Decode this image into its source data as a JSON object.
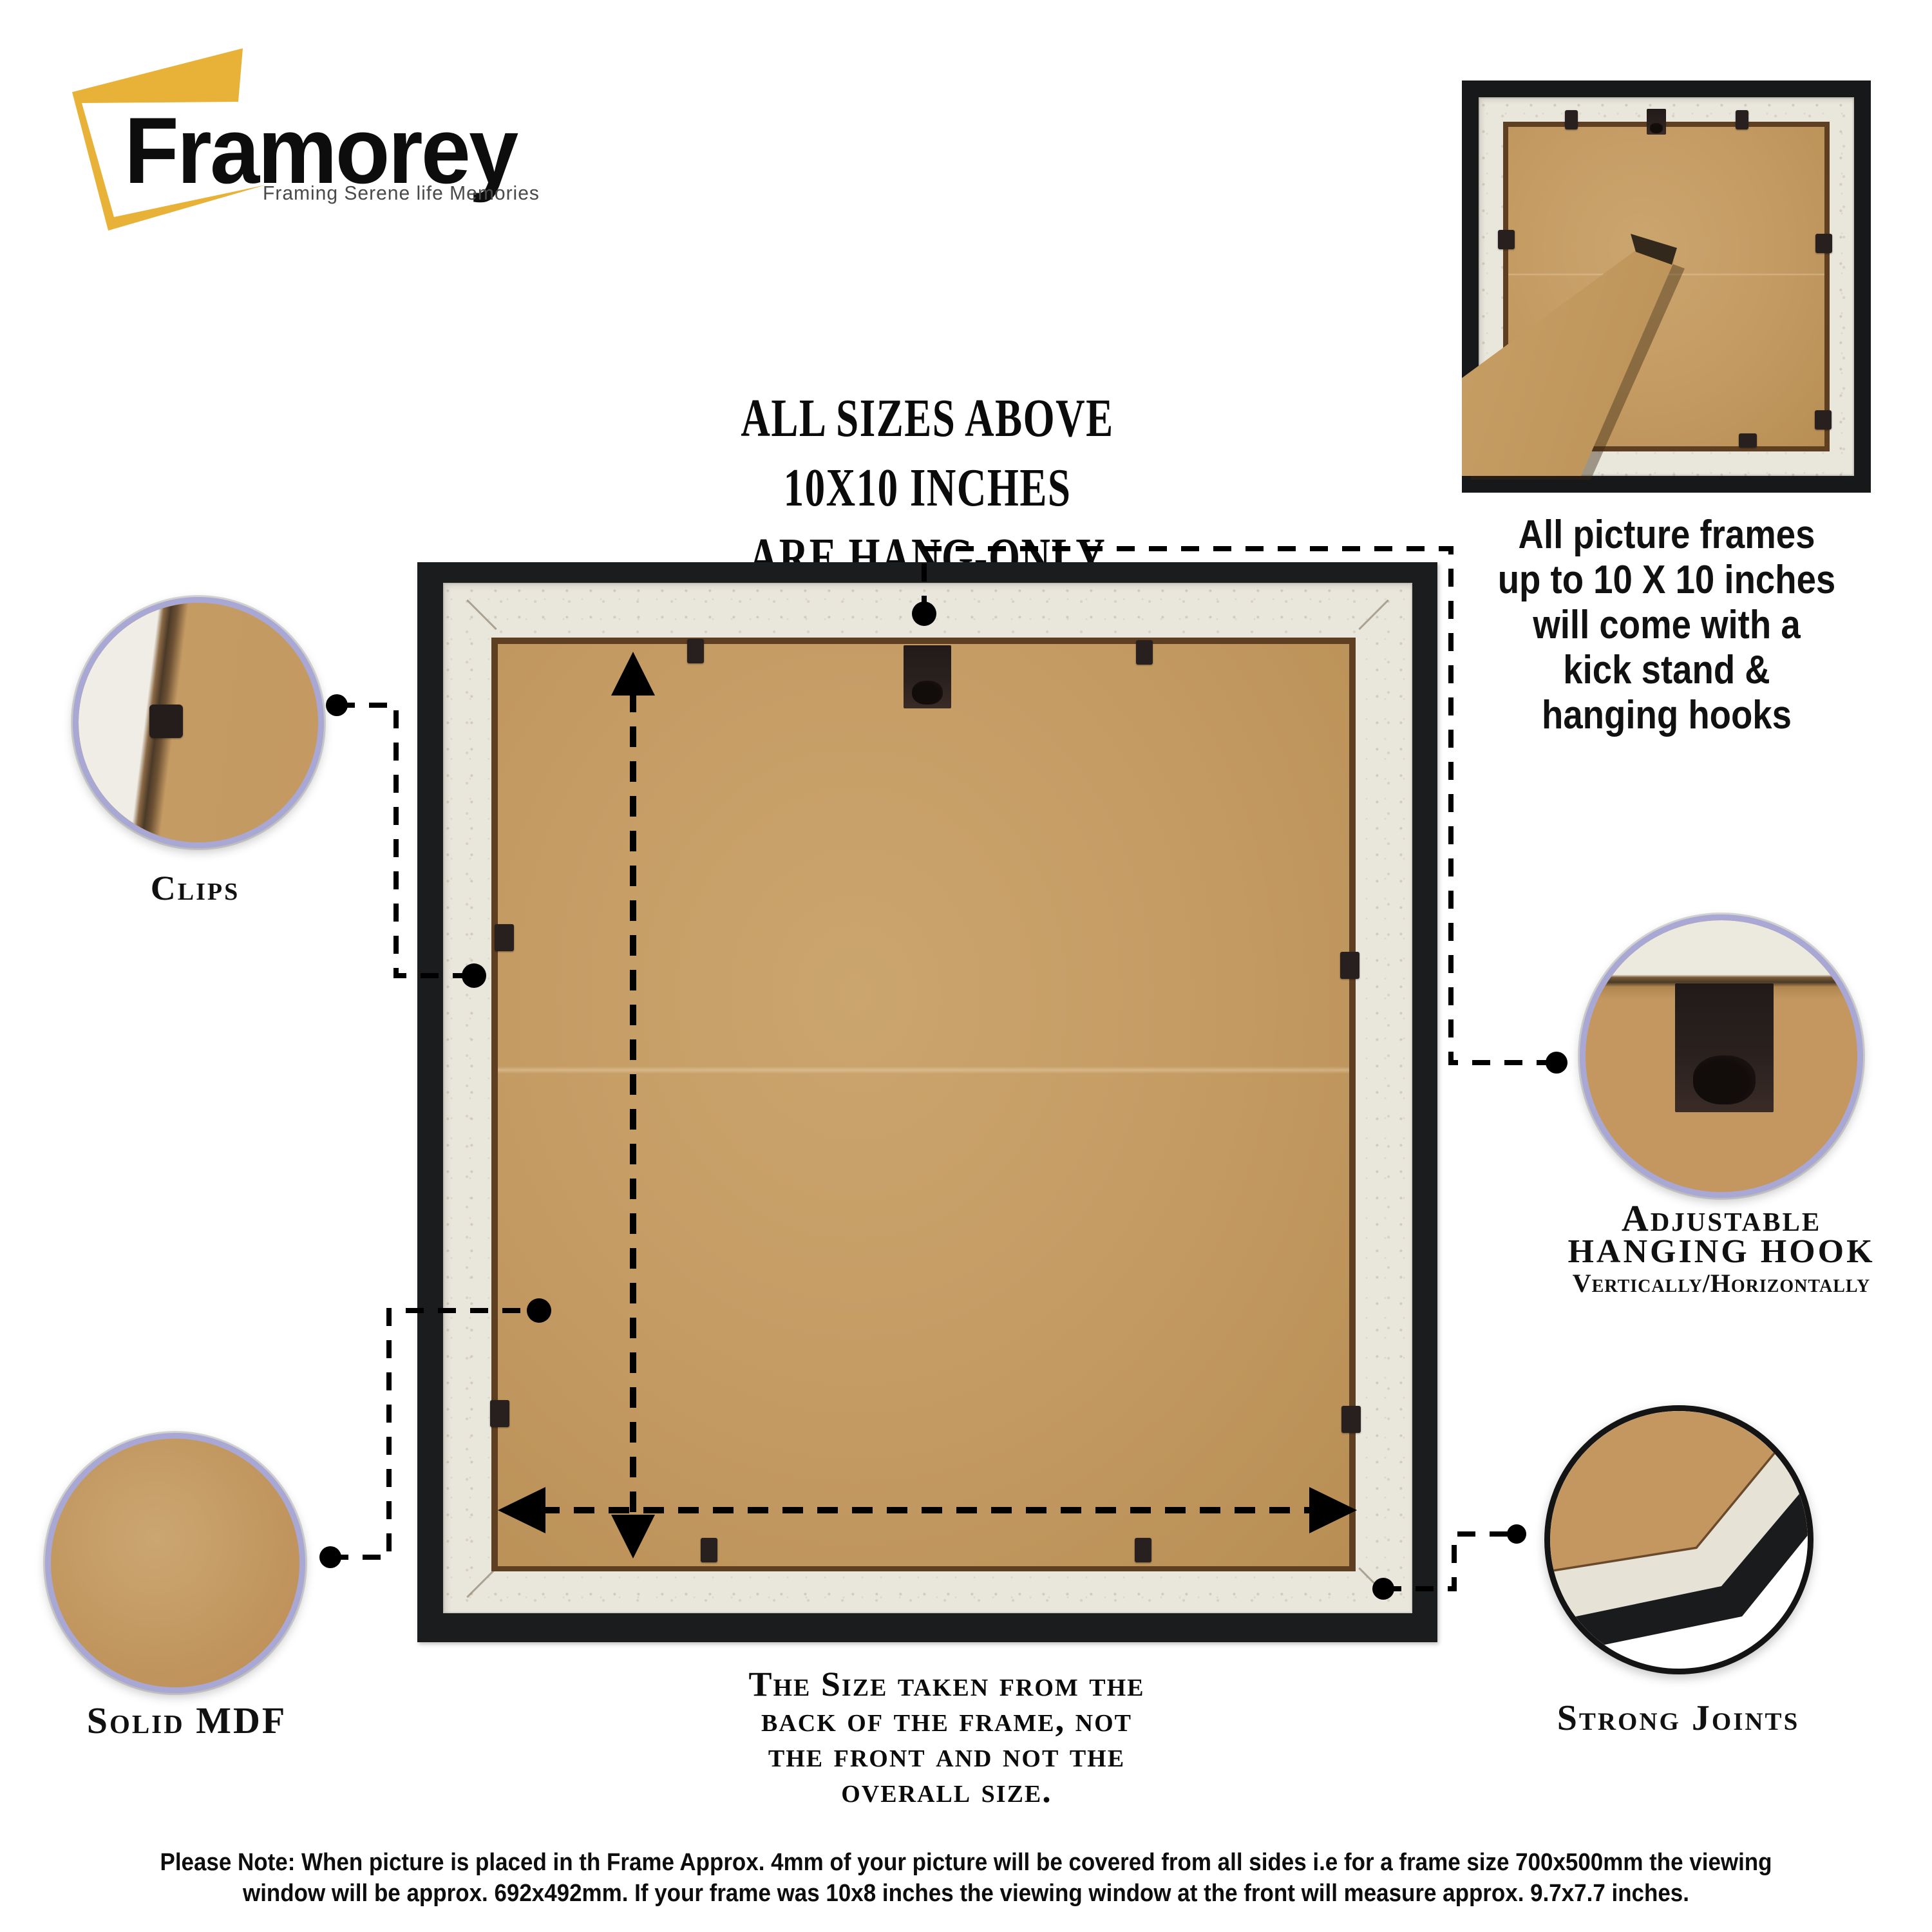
{
  "brand": {
    "name": "Framorey",
    "tagline": "Framing Serene life Memories"
  },
  "heading": {
    "line1": "ALL SIZES ABOVE",
    "line2": "10X10 INCHES",
    "line3": "ARE HANG-ONLY"
  },
  "kickstand_caption": {
    "line1": "All picture frames",
    "line2": "up to 10 X 10 inches",
    "line3": "will come with a",
    "line4": "kick stand &",
    "line5": "hanging hooks"
  },
  "callouts": {
    "clips": {
      "label": "Clips"
    },
    "solid_mdf": {
      "label": "Solid MDF"
    },
    "adjustable_hook": {
      "line1": "Adjustable",
      "line2": "hanging hook",
      "line3": "Vertically/Horizontally"
    },
    "strong_joints": {
      "label": "Strong Joints"
    }
  },
  "size_note": {
    "line1": "The Size taken from the",
    "line2": "back of the frame, not",
    "line3": "the front and not the",
    "line4": "overall size."
  },
  "footer_note": {
    "line1": "Please Note: When picture is placed in th Frame Approx. 4mm of your picture will be covered from all sides i.e for a frame size 700x500mm the viewing",
    "line2": "window will be approx. 692x492mm. If your frame was 10x8 inches the viewing window at the front will measure approx. 9.7x7.7 inches."
  },
  "colors": {
    "accent_yellow": "#E8B238",
    "circle_ring_lavender": "#A9A7D4",
    "circle_ring_black": "#141414",
    "mdf_tan": "#C39A62",
    "board_white": "#E9E6DC",
    "frame_black": "#1B1C1E",
    "connector_black": "#000000"
  }
}
